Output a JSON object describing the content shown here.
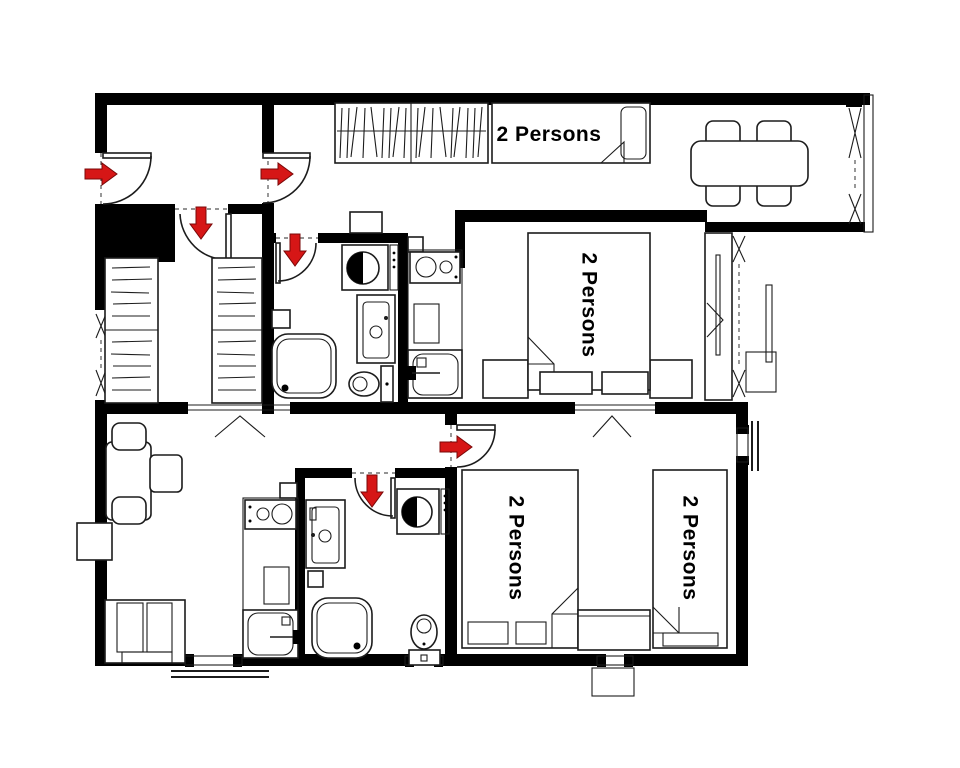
{
  "title": "Apartment floor plan",
  "colors": {
    "background": "#ffffff",
    "wall": "#000000",
    "line": "#1c1c1c",
    "arrow": "#d61616",
    "text": "#000000"
  },
  "labels": {
    "top_bed": "2 Persons",
    "master_bed": "2 Persons",
    "bottom_left_bed": "2 Persons",
    "bottom_right_bed": "2 Persons"
  },
  "icons": {
    "entrance_arrow": "red-direction-arrow",
    "door_swing": "quarter-arc",
    "window": "hatched-x-strip"
  }
}
